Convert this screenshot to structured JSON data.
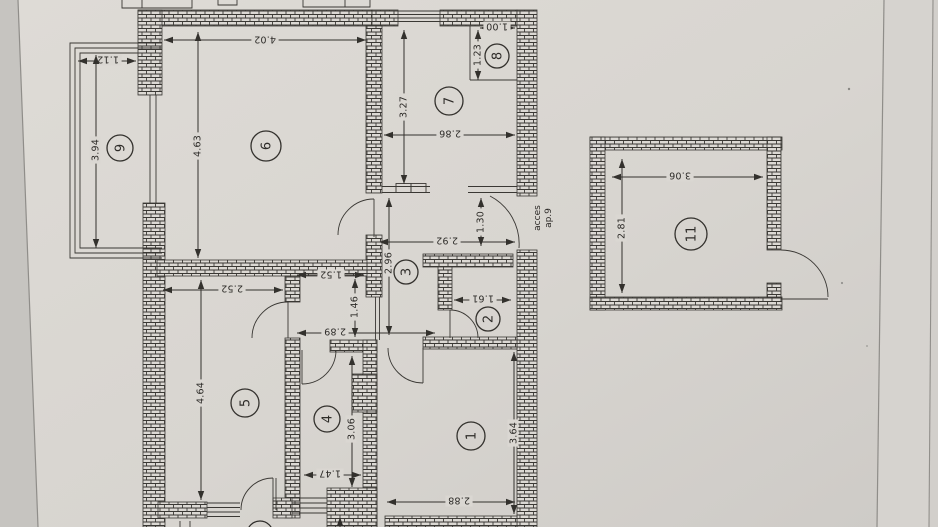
{
  "document": {
    "kind": "scanned floor plan photo",
    "units_note": "meters"
  },
  "colors": {
    "paper": "#dad7d2",
    "paper_dark": "#c9c7c3",
    "ink": "#33312d",
    "edge_line": "#8f8d89"
  },
  "rooms": {
    "r1": "1",
    "r2": "2",
    "r3": "3",
    "r4": "4",
    "r5": "5",
    "r6": "6",
    "r7": "7",
    "r8": "8",
    "r9": "9",
    "r11": "11"
  },
  "dims": {
    "room6_width": "4.02",
    "room6_depth": "4.63",
    "balcony9_width": "1.12",
    "balcony9_length": "3.94",
    "room7_depth": "3.27",
    "room7_width": "2.86",
    "room8_depth": "1.23",
    "room8_width": "1.00",
    "access_door": "1.30",
    "hall_width": "2.92",
    "hall_depth": "2.96",
    "room2_width": "1.61",
    "nook_width": "1.52",
    "nook_depth": "1.46",
    "corridor_width": "2.89",
    "room5_width": "2.52",
    "room5_depth": "4.64",
    "room4_depth": "3.06",
    "room4_width": "1.47",
    "room1_width": "2.88",
    "room1_depth": "3.64",
    "room11_width": "3.06",
    "room11_depth": "2.81"
  },
  "labels": {
    "access_line1": "acces",
    "access_line2": "ap.9"
  }
}
